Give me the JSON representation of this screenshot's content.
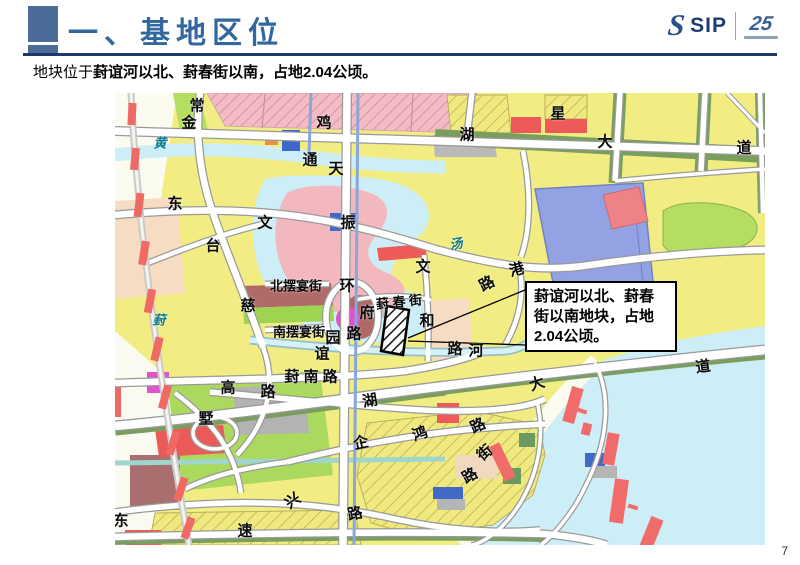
{
  "header": {
    "title": "一、基地区位"
  },
  "logo": {
    "brand": "SIP",
    "anniversary": "25"
  },
  "subtitle": {
    "prefix": "地块位于",
    "emphasis": "葑谊河以北、葑春街以南，占地2.04公顷。"
  },
  "slide": {
    "page_number": "7"
  },
  "map": {
    "callout": {
      "text": "葑谊河以北、葑春街以南地块，占地2.04公顷。"
    },
    "colors": {
      "residential_yellow": "#f2ed82",
      "water_cyan": "#cdeef7",
      "commercial_periwinkle": "#93a2e3",
      "village_pink_hatch": "#f3bcc4",
      "red_parcel": "#ee5a58",
      "green_space": "#abd95e",
      "road_white": "#ffffff",
      "river_blue_line": "#8aa6da",
      "site_hatch_outline": "#000000"
    },
    "labels": [
      {
        "t": "常",
        "x": 82,
        "y": 13
      },
      {
        "t": "金",
        "x": 74,
        "y": 30
      },
      {
        "t": "黄",
        "x": 45,
        "y": 50,
        "k": "river"
      },
      {
        "t": "鸡",
        "x": 209,
        "y": 30
      },
      {
        "t": "湖",
        "x": 352,
        "y": 42
      },
      {
        "t": "星",
        "x": 443,
        "y": 21
      },
      {
        "t": "大",
        "x": 490,
        "y": 49
      },
      {
        "t": "道",
        "x": 629,
        "y": 55
      },
      {
        "t": "通",
        "x": 195,
        "y": 67
      },
      {
        "t": "天",
        "x": 221,
        "y": 76
      },
      {
        "t": "东",
        "x": 60,
        "y": 111
      },
      {
        "t": "文",
        "x": 150,
        "y": 130
      },
      {
        "t": "台",
        "x": 98,
        "y": 153
      },
      {
        "t": "振",
        "x": 233,
        "y": 130
      },
      {
        "t": "汤",
        "x": 341,
        "y": 151,
        "k": "river",
        "r": -10
      },
      {
        "t": "港",
        "x": 402,
        "y": 177,
        "r": -15
      },
      {
        "t": "路",
        "x": 372,
        "y": 191,
        "r": -28
      },
      {
        "t": "文",
        "x": 308,
        "y": 174
      },
      {
        "t": "和",
        "x": 312,
        "y": 228
      },
      {
        "t": "北摆宴街",
        "x": 181,
        "y": 193,
        "s": 13
      },
      {
        "t": "环",
        "x": 232,
        "y": 193
      },
      {
        "t": "葑 春 街",
        "x": 284,
        "y": 209,
        "s": 13,
        "r": -6
      },
      {
        "t": "府",
        "x": 252,
        "y": 220
      },
      {
        "t": "南摆宴街",
        "x": 184,
        "y": 239,
        "s": 13
      },
      {
        "t": "园",
        "x": 218,
        "y": 245
      },
      {
        "t": "路",
        "x": 239,
        "y": 241
      },
      {
        "t": "谊",
        "x": 207,
        "y": 261
      },
      {
        "t": "路",
        "x": 340,
        "y": 256
      },
      {
        "t": "河",
        "x": 361,
        "y": 258
      },
      {
        "t": "葑 南 路",
        "x": 196,
        "y": 284
      },
      {
        "t": "慈",
        "x": 133,
        "y": 213
      },
      {
        "t": "葑",
        "x": 44,
        "y": 227,
        "k": "river"
      },
      {
        "t": "高",
        "x": 113,
        "y": 295
      },
      {
        "t": "路",
        "x": 153,
        "y": 299
      },
      {
        "t": "墅",
        "x": 91,
        "y": 326
      },
      {
        "t": "湖",
        "x": 255,
        "y": 308,
        "r": -10
      },
      {
        "t": "大",
        "x": 422,
        "y": 291,
        "r": -18
      },
      {
        "t": "道",
        "x": 588,
        "y": 274,
        "r": -8
      },
      {
        "t": "企",
        "x": 246,
        "y": 350,
        "r": -12
      },
      {
        "t": "鸿",
        "x": 305,
        "y": 341,
        "r": -18
      },
      {
        "t": "路",
        "x": 363,
        "y": 333,
        "r": -25
      },
      {
        "t": "街",
        "x": 370,
        "y": 360,
        "r": -40
      },
      {
        "t": "路",
        "x": 355,
        "y": 383,
        "r": -30
      },
      {
        "t": "兴",
        "x": 178,
        "y": 408,
        "r": -35
      },
      {
        "t": "路",
        "x": 240,
        "y": 421,
        "r": -12
      },
      {
        "t": "速",
        "x": 130,
        "y": 438
      },
      {
        "t": "东",
        "x": 6,
        "y": 428
      }
    ]
  }
}
